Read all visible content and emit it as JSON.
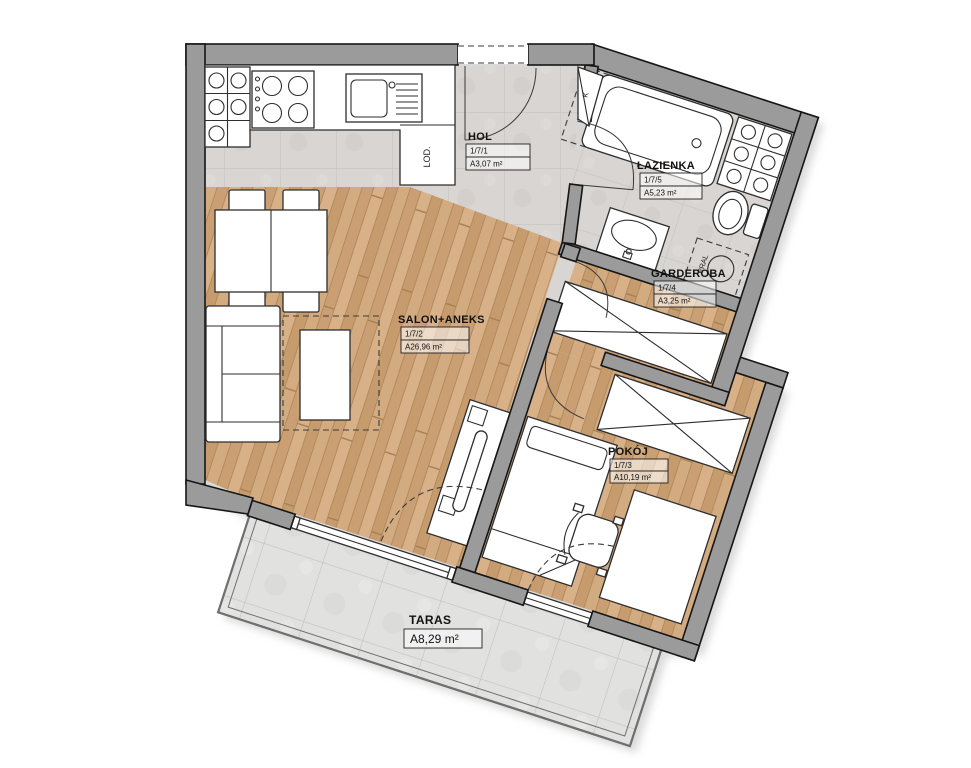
{
  "plan": {
    "rooms": [
      {
        "name": "HOL",
        "id": "1/7/1",
        "area": "A3,07 m²"
      },
      {
        "name": "ŁAZIENKA",
        "id": "1/7/5",
        "area": "A5,23 m²"
      },
      {
        "name": "GARDEROBA",
        "id": "1/7/4",
        "area": "A3,25 m²"
      },
      {
        "name": "SALON+ANEKS",
        "id": "1/7/2",
        "area": "A26,96 m²"
      },
      {
        "name": "POKÓJ",
        "id": "1/7/3",
        "area": "A10,19 m²"
      },
      {
        "name": "TARAS",
        "area": "A8,29 m²"
      }
    ],
    "appliances": {
      "fridge": "LOD.",
      "washing_machine": "PRAL",
      "vent_shaft": "K"
    },
    "colors": {
      "wall": "#9b9b9b",
      "wall_edge": "#161616",
      "wood": "#cfa87e",
      "gray_tile": "#d8d5d2",
      "terrace_tile": "#e1e1df",
      "furniture_fill": "#ffffff",
      "furniture_stroke": "#2e2e2e"
    }
  }
}
